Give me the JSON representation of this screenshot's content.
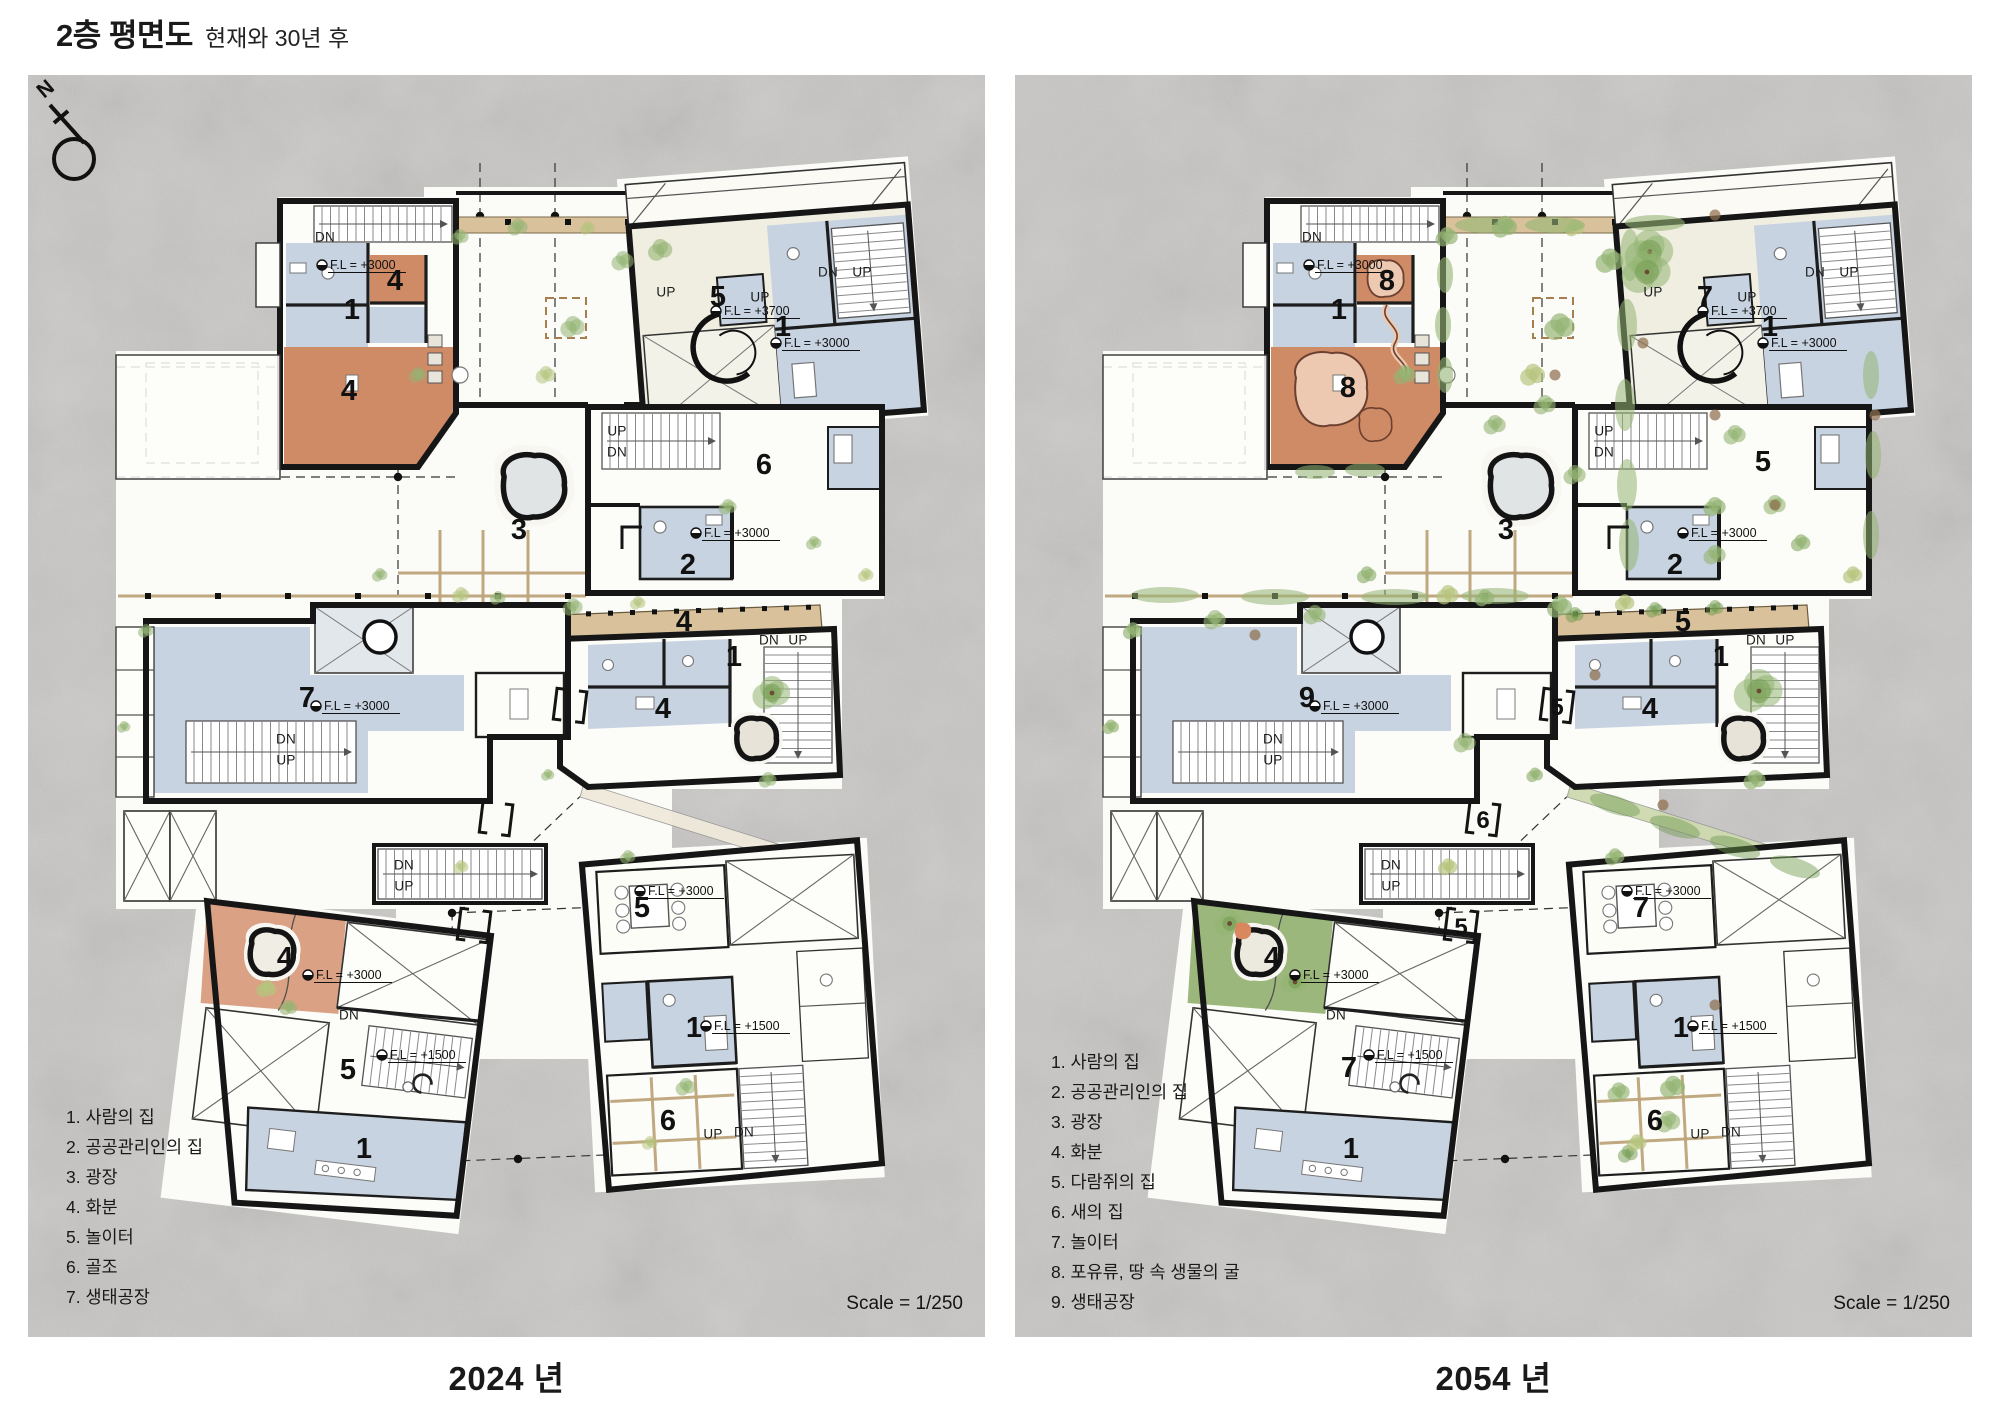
{
  "title": {
    "main": "2층 평면도",
    "subtitle": "현재와 30년 후"
  },
  "north_indicator": "N",
  "colors": {
    "stone": "#c9c7c5",
    "wall": "#161616",
    "room_white": "#fcfcf8",
    "room_cream": "#efeee1",
    "room_blue": "#c7d3e1",
    "terracotta": "#cf8a66",
    "terracotta_light": "#ecc9b0",
    "deck_tan": "#d9c29b",
    "pergola_tan": "#bda379",
    "vegetation_green": "#94b473",
    "vegetation_dark": "#6f9a4e",
    "vegetation_yellow": "#b5c47e",
    "soil_brown": "#8f6f4e",
    "pond_fill": "#e0e4e5",
    "green_area": "#9cb77c"
  },
  "panels": [
    {
      "caption": "2024 년",
      "scale_label": "Scale = 1/250",
      "legend": [
        "1. 사람의 집",
        "2. 공공관리인의 집",
        "3. 광장",
        "4. 화분",
        "5. 놀이터",
        "6. 골조",
        "7. 생태공장"
      ],
      "plan_labels": [
        {
          "t": "DN",
          "x": 297,
          "y": 162,
          "s": "sm"
        },
        {
          "t": "F.L = +3000",
          "x": 306,
          "y": 190,
          "s": "fl"
        },
        {
          "t": "4",
          "x": 367,
          "y": 205,
          "s": "num"
        },
        {
          "t": "1",
          "x": 324,
          "y": 234,
          "s": "num"
        },
        {
          "t": "4",
          "x": 321,
          "y": 315,
          "s": "num"
        },
        {
          "t": "UP",
          "x": 638,
          "y": 217,
          "s": "sm"
        },
        {
          "t": "5",
          "x": 690,
          "y": 221,
          "s": "num"
        },
        {
          "t": "F.L = +3700",
          "x": 700,
          "y": 236,
          "s": "fl"
        },
        {
          "t": "UP",
          "x": 732,
          "y": 222,
          "s": "sm"
        },
        {
          "t": "DN",
          "x": 800,
          "y": 197,
          "s": "sm"
        },
        {
          "t": "UP",
          "x": 834,
          "y": 197,
          "s": "sm"
        },
        {
          "t": "1",
          "x": 755,
          "y": 251,
          "s": "num"
        },
        {
          "t": "F.L = +3000",
          "x": 760,
          "y": 268,
          "s": "fl"
        },
        {
          "t": "UP",
          "x": 589,
          "y": 356,
          "s": "sm"
        },
        {
          "t": "DN",
          "x": 589,
          "y": 377,
          "s": "sm"
        },
        {
          "t": "6",
          "x": 736,
          "y": 389,
          "s": "num"
        },
        {
          "t": "3",
          "x": 491,
          "y": 454,
          "s": "num"
        },
        {
          "t": "F.L = +3000",
          "x": 680,
          "y": 458,
          "s": "fl"
        },
        {
          "t": "2",
          "x": 660,
          "y": 489,
          "s": "num"
        },
        {
          "t": "4",
          "x": 656,
          "y": 546,
          "s": "num"
        },
        {
          "t": "DN",
          "x": 741,
          "y": 565,
          "s": "sm"
        },
        {
          "t": "UP",
          "x": 770,
          "y": 565,
          "s": "sm"
        },
        {
          "t": "1",
          "x": 706,
          "y": 581,
          "s": "num"
        },
        {
          "t": "4",
          "x": 635,
          "y": 633,
          "s": "num"
        },
        {
          "t": "7",
          "x": 279,
          "y": 622,
          "s": "num"
        },
        {
          "t": "F.L = +3000",
          "x": 300,
          "y": 631,
          "s": "fl"
        },
        {
          "t": "DN",
          "x": 258,
          "y": 664,
          "s": "sm"
        },
        {
          "t": "UP",
          "x": 258,
          "y": 685,
          "s": "sm"
        },
        {
          "t": "DN",
          "x": 376,
          "y": 790,
          "s": "sm"
        },
        {
          "t": "UP",
          "x": 376,
          "y": 811,
          "s": "sm"
        },
        {
          "t": "4",
          "x": 257,
          "y": 882,
          "s": "num"
        },
        {
          "t": "F.L = +3000",
          "x": 292,
          "y": 900,
          "s": "fl"
        },
        {
          "t": "DN",
          "x": 321,
          "y": 940,
          "s": "sm"
        },
        {
          "t": "F.L = +1500",
          "x": 366,
          "y": 980,
          "s": "fl"
        },
        {
          "t": "5",
          "x": 320,
          "y": 994,
          "s": "num"
        },
        {
          "t": "1",
          "x": 336,
          "y": 1073,
          "s": "num"
        },
        {
          "t": "F.L = +3000",
          "x": 624,
          "y": 816,
          "s": "fl"
        },
        {
          "t": "5",
          "x": 614,
          "y": 832,
          "s": "num"
        },
        {
          "t": "F.L = +1500",
          "x": 690,
          "y": 951,
          "s": "fl"
        },
        {
          "t": "1",
          "x": 666,
          "y": 952,
          "s": "num"
        },
        {
          "t": "6",
          "x": 640,
          "y": 1045,
          "s": "num"
        },
        {
          "t": "UP",
          "x": 685,
          "y": 1059,
          "s": "sm"
        },
        {
          "t": "DN",
          "x": 716,
          "y": 1057,
          "s": "sm"
        }
      ]
    },
    {
      "caption": "2054 년",
      "scale_label": "Scale = 1/250",
      "legend": [
        "1. 사람의 집",
        "2. 공공관리인의 집",
        "3. 광장",
        "4. 화분",
        "5. 다람쥐의 집",
        "6. 새의 집",
        "7. 놀이터",
        "8. 포유류, 땅 속 생물의 굴",
        "9. 생태공장"
      ],
      "plan_labels": [
        {
          "t": "DN",
          "x": 297,
          "y": 162,
          "s": "sm"
        },
        {
          "t": "F.L = +3000",
          "x": 306,
          "y": 190,
          "s": "fl"
        },
        {
          "t": "8",
          "x": 372,
          "y": 205,
          "s": "num"
        },
        {
          "t": "1",
          "x": 324,
          "y": 234,
          "s": "num"
        },
        {
          "t": "8",
          "x": 333,
          "y": 312,
          "s": "num"
        },
        {
          "t": "UP",
          "x": 638,
          "y": 217,
          "s": "sm"
        },
        {
          "t": "7",
          "x": 690,
          "y": 221,
          "s": "num"
        },
        {
          "t": "F.L = +3700",
          "x": 700,
          "y": 236,
          "s": "fl"
        },
        {
          "t": "UP",
          "x": 732,
          "y": 222,
          "s": "sm"
        },
        {
          "t": "DN",
          "x": 800,
          "y": 197,
          "s": "sm"
        },
        {
          "t": "UP",
          "x": 834,
          "y": 197,
          "s": "sm"
        },
        {
          "t": "1",
          "x": 755,
          "y": 251,
          "s": "num"
        },
        {
          "t": "F.L = +3000",
          "x": 760,
          "y": 268,
          "s": "fl"
        },
        {
          "t": "UP",
          "x": 589,
          "y": 356,
          "s": "sm"
        },
        {
          "t": "DN",
          "x": 589,
          "y": 377,
          "s": "sm"
        },
        {
          "t": "5",
          "x": 748,
          "y": 386,
          "s": "num"
        },
        {
          "t": "3",
          "x": 491,
          "y": 454,
          "s": "num"
        },
        {
          "t": "F.L = +3000",
          "x": 680,
          "y": 458,
          "s": "fl"
        },
        {
          "t": "2",
          "x": 660,
          "y": 489,
          "s": "num"
        },
        {
          "t": "5",
          "x": 668,
          "y": 546,
          "s": "num"
        },
        {
          "t": "DN",
          "x": 741,
          "y": 565,
          "s": "sm"
        },
        {
          "t": "UP",
          "x": 770,
          "y": 565,
          "s": "sm"
        },
        {
          "t": "1",
          "x": 706,
          "y": 581,
          "s": "num"
        },
        {
          "t": "4",
          "x": 635,
          "y": 633,
          "s": "num"
        },
        {
          "t": "9",
          "x": 292,
          "y": 622,
          "s": "num"
        },
        {
          "t": "F.L = +3000",
          "x": 312,
          "y": 631,
          "s": "fl"
        },
        {
          "t": "DN",
          "x": 258,
          "y": 664,
          "s": "sm"
        },
        {
          "t": "UP",
          "x": 258,
          "y": 685,
          "s": "sm"
        },
        {
          "t": "5",
          "x": 542,
          "y": 631,
          "s": "numbox"
        },
        {
          "t": "DN",
          "x": 376,
          "y": 790,
          "s": "sm"
        },
        {
          "t": "UP",
          "x": 376,
          "y": 811,
          "s": "sm"
        },
        {
          "t": "6",
          "x": 468,
          "y": 744,
          "s": "numbox"
        },
        {
          "t": "5",
          "x": 446,
          "y": 851,
          "s": "numbox"
        },
        {
          "t": "4",
          "x": 257,
          "y": 882,
          "s": "num"
        },
        {
          "t": "F.L = +3000",
          "x": 292,
          "y": 900,
          "s": "fl"
        },
        {
          "t": "DN",
          "x": 321,
          "y": 940,
          "s": "sm"
        },
        {
          "t": "F.L = +1500",
          "x": 366,
          "y": 980,
          "s": "fl"
        },
        {
          "t": "7",
          "x": 334,
          "y": 992,
          "s": "num"
        },
        {
          "t": "1",
          "x": 336,
          "y": 1073,
          "s": "num"
        },
        {
          "t": "F.L = +3000",
          "x": 624,
          "y": 816,
          "s": "fl"
        },
        {
          "t": "7",
          "x": 626,
          "y": 832,
          "s": "num"
        },
        {
          "t": "F.L = +1500",
          "x": 690,
          "y": 951,
          "s": "fl"
        },
        {
          "t": "1",
          "x": 666,
          "y": 952,
          "s": "num"
        },
        {
          "t": "6",
          "x": 640,
          "y": 1045,
          "s": "num"
        },
        {
          "t": "UP",
          "x": 685,
          "y": 1059,
          "s": "sm"
        },
        {
          "t": "DN",
          "x": 716,
          "y": 1057,
          "s": "sm"
        }
      ]
    }
  ]
}
